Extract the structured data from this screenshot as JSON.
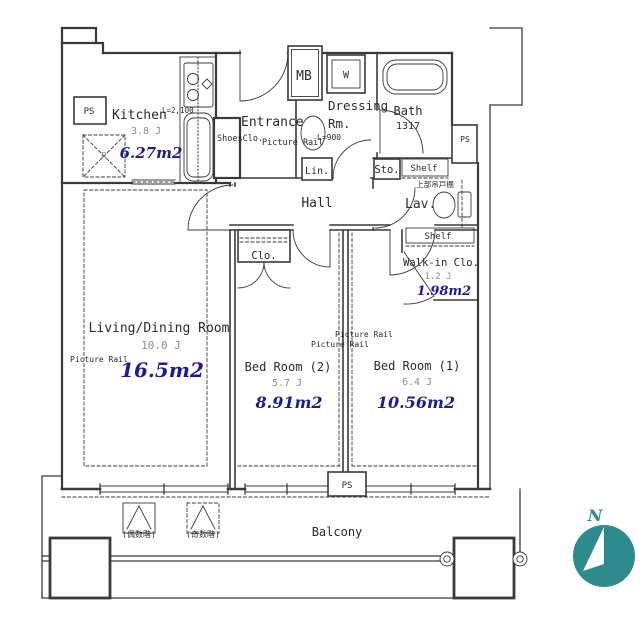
{
  "colors": {
    "line": "#3a3a3a",
    "area_text": "#1b1b97",
    "muted_text": "#8c8c8c",
    "compass_teal": "#2e8b8d",
    "background": "#ffffff"
  },
  "plan": {
    "kitchen": {
      "name": "Kitchen",
      "rail_note": "L=2,100",
      "tatami": "3.8 J",
      "area": "6.27m2",
      "fridge": "R",
      "ps": "PS"
    },
    "entrance": {
      "name": "Entrance",
      "shoes_closet": "ShoesClo.",
      "picture_rail": "Picture Rail",
      "rail_length": "L=900",
      "meter_box": "MB"
    },
    "dressing": {
      "name_line1": "Dressing",
      "name_line2": "Rm.",
      "washer": "W"
    },
    "bath": {
      "name": "Bath",
      "size": "1317"
    },
    "utility": {
      "storage": "Sto.",
      "linen": "Lin.",
      "shelf": "Shelf",
      "upper_cabinet": "上部吊戸棚",
      "ps": "PS"
    },
    "lavatory": {
      "name": "Lav."
    },
    "hall": {
      "name": "Hall",
      "closet": "Clo."
    },
    "walkin": {
      "shelf": "Shelf",
      "name": "Walk-in Clo.",
      "tatami": "1.2 J",
      "area": "1.98m2"
    },
    "living": {
      "name": "Living/Dining Room",
      "tatami": "10.0 J",
      "picture_rail": "Picture Rail",
      "area": "16.5m2"
    },
    "bed2": {
      "picture_rail_1": "Picture Rail",
      "picture_rail_2": "Picture Rail",
      "name": "Bed Room (2)",
      "tatami": "5.7 J",
      "area": "8.91m2"
    },
    "bed1": {
      "name": "Bed Room (1)",
      "tatami": "6.4 J",
      "area": "10.56m2"
    },
    "balcony": {
      "name": "Balcony",
      "hatch_even": "(偶数階)",
      "hatch_odd": "(奇数階)",
      "ps": "PS"
    },
    "compass": {
      "north": "N"
    }
  }
}
